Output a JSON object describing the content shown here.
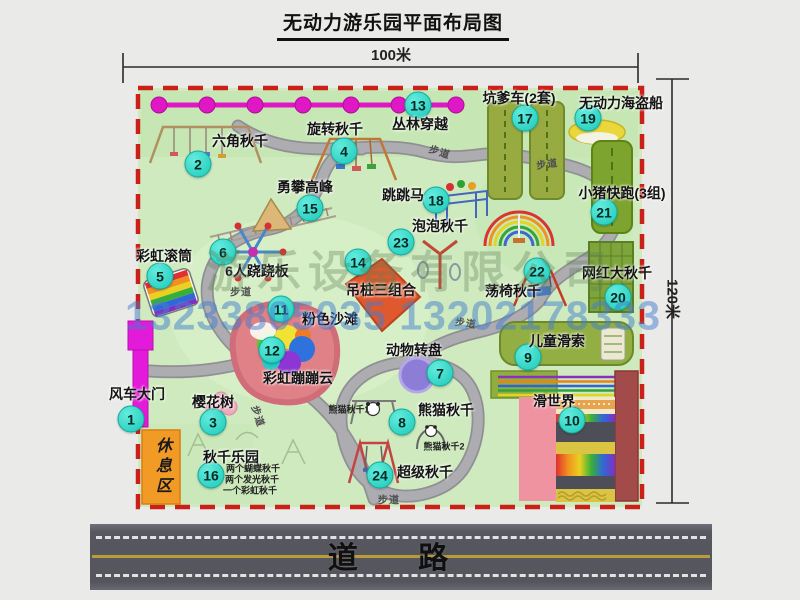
{
  "title": "无动力游乐园平面布局图",
  "dims": {
    "width_label": "100米",
    "height_label": "120米"
  },
  "road": {
    "label": "道  路"
  },
  "watermark": {
    "company": "游乐设备有限公司",
    "phone": "13233805035 13202178333"
  },
  "colors": {
    "map_green": "#cfeabf",
    "border_red": "#cb2017",
    "badge_cyan": "#2fd8ca",
    "zipline_magenta": "#df17c4",
    "gate_magenta": "#e31ad9",
    "rest_orange": "#f29a26",
    "path_gray": "#abacaf",
    "road_gray": "#57575f",
    "road_yellow": "#bb9c36"
  },
  "map": {
    "labels": [
      {
        "num": "1",
        "label": "风车大门",
        "name": "windmill-gate",
        "lx": 137,
        "ly": 394,
        "bx": 131,
        "by": 419
      },
      {
        "num": "2",
        "label": "六角秋千",
        "name": "hexagon-swing",
        "lx": 240,
        "ly": 141,
        "bx": 198,
        "by": 164
      },
      {
        "num": "3",
        "label": "樱花树",
        "name": "cherry-tree",
        "lx": 213,
        "ly": 402,
        "bx": 213,
        "by": 422
      },
      {
        "num": "4",
        "label": "旋转秋千",
        "name": "rotating-swing",
        "lx": 335,
        "ly": 129,
        "bx": 344,
        "by": 151
      },
      {
        "num": "5",
        "label": "彩虹滚筒",
        "name": "rainbow-roller",
        "lx": 164,
        "ly": 256,
        "bx": 160,
        "by": 276
      },
      {
        "num": "6",
        "label": "6人跷跷板",
        "name": "six-person-seesaw",
        "lx": 257,
        "ly": 271,
        "bx": 223,
        "by": 252
      },
      {
        "num": "7",
        "label": "动物转盘",
        "name": "animal-carousel",
        "lx": 414,
        "ly": 350,
        "bx": 440,
        "by": 373
      },
      {
        "num": "8",
        "label": "熊猫秋千",
        "name": "panda-swing",
        "lx": 446,
        "ly": 410,
        "bx": 402,
        "by": 422
      },
      {
        "num": "9",
        "label": "儿童滑索",
        "name": "kids-zipline",
        "lx": 557,
        "ly": 341,
        "bx": 528,
        "by": 357
      },
      {
        "num": "10",
        "label": "滑世界",
        "name": "slide-world",
        "lx": 554,
        "ly": 401,
        "bx": 572,
        "by": 420
      },
      {
        "num": "11",
        "label": "粉色沙滩",
        "name": "pink-beach",
        "lx": 330,
        "ly": 319,
        "bx": 281,
        "by": 309
      },
      {
        "num": "12",
        "label": "彩虹蹦蹦云",
        "name": "rainbow-bounce-cloud",
        "lx": 298,
        "ly": 378,
        "bx": 272,
        "by": 350
      },
      {
        "num": "13",
        "label": "丛林穿越",
        "name": "jungle-crossing",
        "lx": 420,
        "ly": 124,
        "bx": 418,
        "by": 105
      },
      {
        "num": "14",
        "label": "吊桩三组合",
        "name": "hanging-pile-combo",
        "lx": 381,
        "ly": 290,
        "bx": 358,
        "by": 262
      },
      {
        "num": "15",
        "label": "勇攀高峰",
        "name": "climbing-peak",
        "lx": 305,
        "ly": 187,
        "bx": 310,
        "by": 208
      },
      {
        "num": "16",
        "label": "秋千乐园",
        "name": "swing-park",
        "lx": 231,
        "ly": 457,
        "bx": 211,
        "by": 475
      },
      {
        "num": "17",
        "label": "坑爹车(2套)",
        "name": "pit-cart",
        "lx": 519,
        "ly": 98,
        "bx": 525,
        "by": 118
      },
      {
        "num": "18",
        "label": "跳跳马",
        "name": "jumping-horse",
        "lx": 403,
        "ly": 195,
        "bx": 436,
        "by": 200
      },
      {
        "num": "19",
        "label": "无动力海盗船",
        "name": "pirate-ship",
        "lx": 621,
        "ly": 103,
        "bx": 588,
        "by": 118
      },
      {
        "num": "20",
        "label": "网红大秋千",
        "name": "big-net-swing",
        "lx": 617,
        "ly": 273,
        "bx": 618,
        "by": 297
      },
      {
        "num": "21",
        "label": "小猪快跑(3组)",
        "name": "piggy-run",
        "lx": 622,
        "ly": 193,
        "bx": 604,
        "by": 212
      },
      {
        "num": "22",
        "label": "荡椅秋千",
        "name": "chair-swing",
        "lx": 513,
        "ly": 291,
        "bx": 537,
        "by": 271
      },
      {
        "num": "23",
        "label": "泡泡秋千",
        "name": "bubble-swing",
        "lx": 440,
        "ly": 226,
        "bx": 401,
        "by": 242
      },
      {
        "num": "24",
        "label": "超级秋千",
        "name": "super-swing",
        "lx": 425,
        "ly": 472,
        "bx": 380,
        "by": 475
      },
      {
        "label": "休息区",
        "name": "rest-area-label",
        "cls": "vert",
        "lx": 161,
        "ly": 467
      },
      {
        "label": "两个蝴蝶秋千",
        "name": "swing-park-line-1",
        "cls": "tiny",
        "lx": 253,
        "ly": 468
      },
      {
        "label": "两个发光秋千",
        "name": "swing-park-line-2",
        "cls": "tiny",
        "lx": 252,
        "ly": 479
      },
      {
        "label": "一个彩虹秋千",
        "name": "swing-park-line-3",
        "cls": "tiny",
        "lx": 250,
        "ly": 490
      },
      {
        "label": "熊猫秋千1",
        "name": "panda-swing-sub-1",
        "cls": "tiny",
        "lx": 349,
        "ly": 409
      },
      {
        "label": "熊猫秋千2",
        "name": "panda-swing-sub-2",
        "cls": "tiny",
        "lx": 444,
        "ly": 446
      },
      {
        "label": "步道",
        "name": "footpath-label",
        "cls": "path",
        "lx": 440,
        "ly": 151,
        "rot": 18
      },
      {
        "label": "步道",
        "name": "footpath-label",
        "cls": "path",
        "lx": 547,
        "ly": 163,
        "rot": -8
      },
      {
        "label": "步道",
        "name": "footpath-label",
        "cls": "path",
        "lx": 241,
        "ly": 291
      },
      {
        "label": "步道",
        "name": "footpath-label",
        "cls": "path",
        "lx": 259,
        "ly": 416,
        "rot": 72
      },
      {
        "label": "步道",
        "name": "footpath-label",
        "cls": "path",
        "lx": 466,
        "ly": 322,
        "rot": 8
      },
      {
        "label": "步道",
        "name": "footpath-label",
        "cls": "path",
        "lx": 389,
        "ly": 499
      }
    ]
  }
}
